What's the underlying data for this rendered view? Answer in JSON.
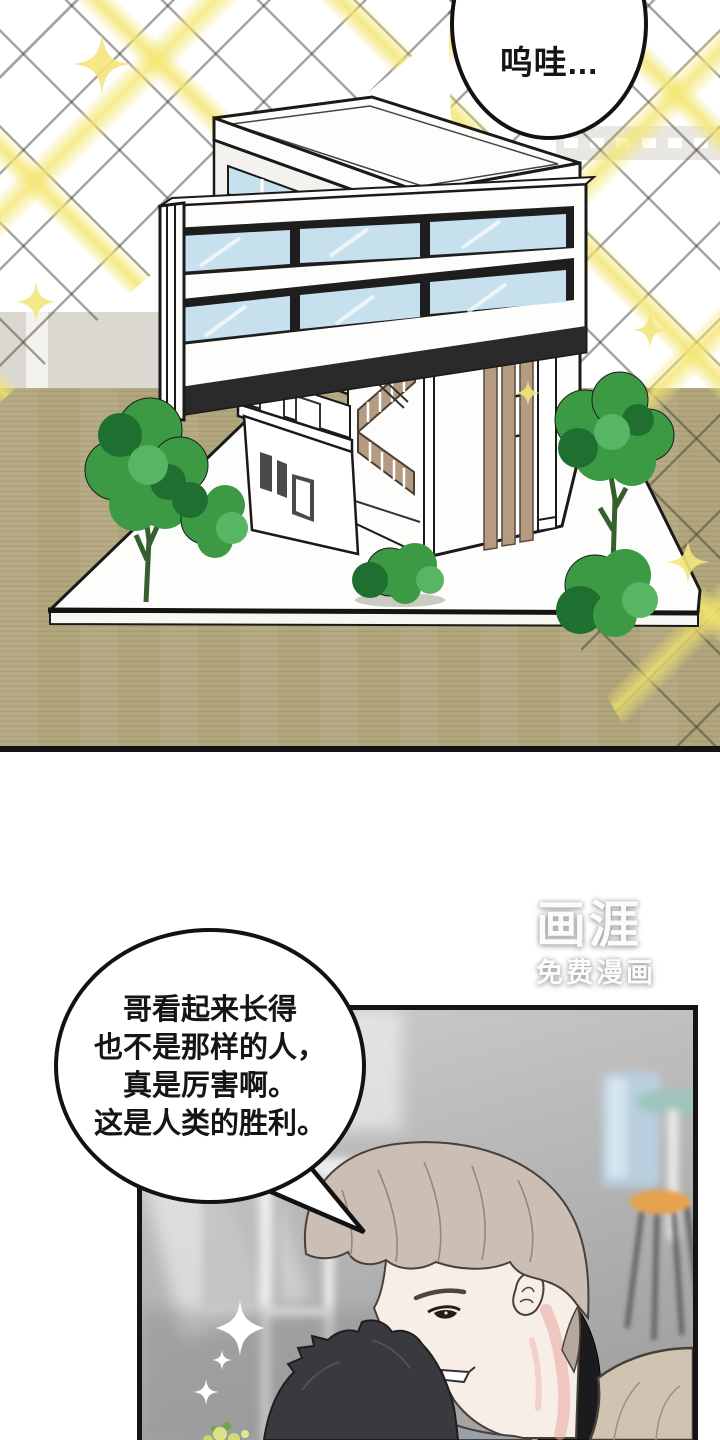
{
  "page": {
    "width": 720,
    "height": 1440,
    "type": "webtoon-comic-page"
  },
  "panel1": {
    "description": "architectural model of a modern house on a wooden table with sparkle lattice background",
    "speech_bubble": {
      "text": "呜哇..."
    },
    "objects": [
      "architectural-model-building",
      "model-base-platform",
      "model-trees",
      "sparkle-lattice",
      "wooden-table",
      "grey-wall"
    ]
  },
  "panel2": {
    "description": "classroom scene, beige-haired man looking down at dark-haired person",
    "speech_bubble": {
      "lines": [
        "哥看起来长得",
        "也不是那样的人，",
        "真是厉害啊。",
        "这是人类的胜利。"
      ]
    },
    "objects": [
      "beige-haired-man",
      "dark-haired-head",
      "white-chair",
      "blue-trash-bin",
      "teal-table",
      "orange-stool",
      "white-sparkles",
      "small-flowers"
    ]
  },
  "watermark": {
    "logo": "画涯",
    "subtitle": "免费漫画"
  },
  "palette": {
    "ink": "#141414",
    "glass": "#c7e0ed",
    "wood": "#b59b82",
    "floor": "#b1a67c",
    "wall": "#dbd8d2",
    "sun": "#f3e57c",
    "leaf": "#3c9a44",
    "leafdark": "#1f7030",
    "leaflight": "#58b563",
    "hair": "#cbbfb5",
    "skin": "#f7efe7",
    "blush": "#eba6a0",
    "jacket": "#cfc3b2",
    "collar": "#1b1b1d",
    "shirt": "#98a0ab",
    "stool": "#e7a24e",
    "bin": "#b9d0e2",
    "teal": "#9dc5bb"
  }
}
